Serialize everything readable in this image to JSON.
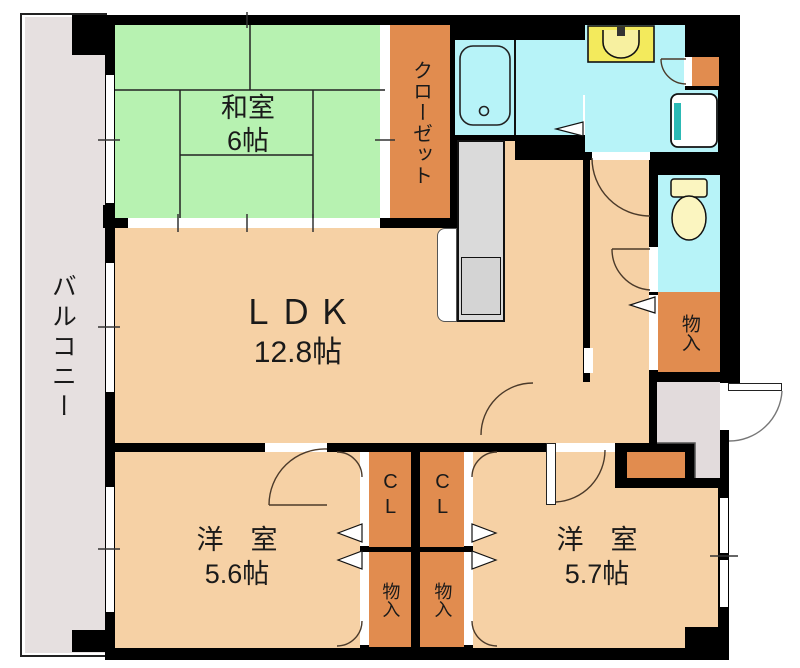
{
  "plan": {
    "balcony_label": "バルコニー",
    "washitsu_label": "和室",
    "washitsu_size": "6帖",
    "closet_label": "クローゼット",
    "ldk_label": "ＬＤＫ",
    "ldk_size": "12.8帖",
    "bedroom_left_label": "洋　室",
    "bedroom_left_size": "5.6帖",
    "bedroom_right_label": "洋　室",
    "bedroom_right_size": "5.7帖",
    "storage_hall_label": "物入",
    "cl_left_label": "CL",
    "cl_right_label": "CL",
    "storage_left_label": "物入",
    "storage_right_label": "物入"
  },
  "colors": {
    "wall": "#000000",
    "floor_peach": "#F6D1A5",
    "tatami_green": "#B7F2B1",
    "storage_orange": "#E18C4F",
    "wet_cyan": "#B7F3F8",
    "balcony_gray": "#E6E0E0",
    "genkan_gray": "#E2DBDC",
    "kitchen_gray": "#DADADA",
    "vanity_yellow": "#F3EA5C",
    "toilet_yellow": "#FBF5C0",
    "pan_teal": "#2CB9B5"
  }
}
